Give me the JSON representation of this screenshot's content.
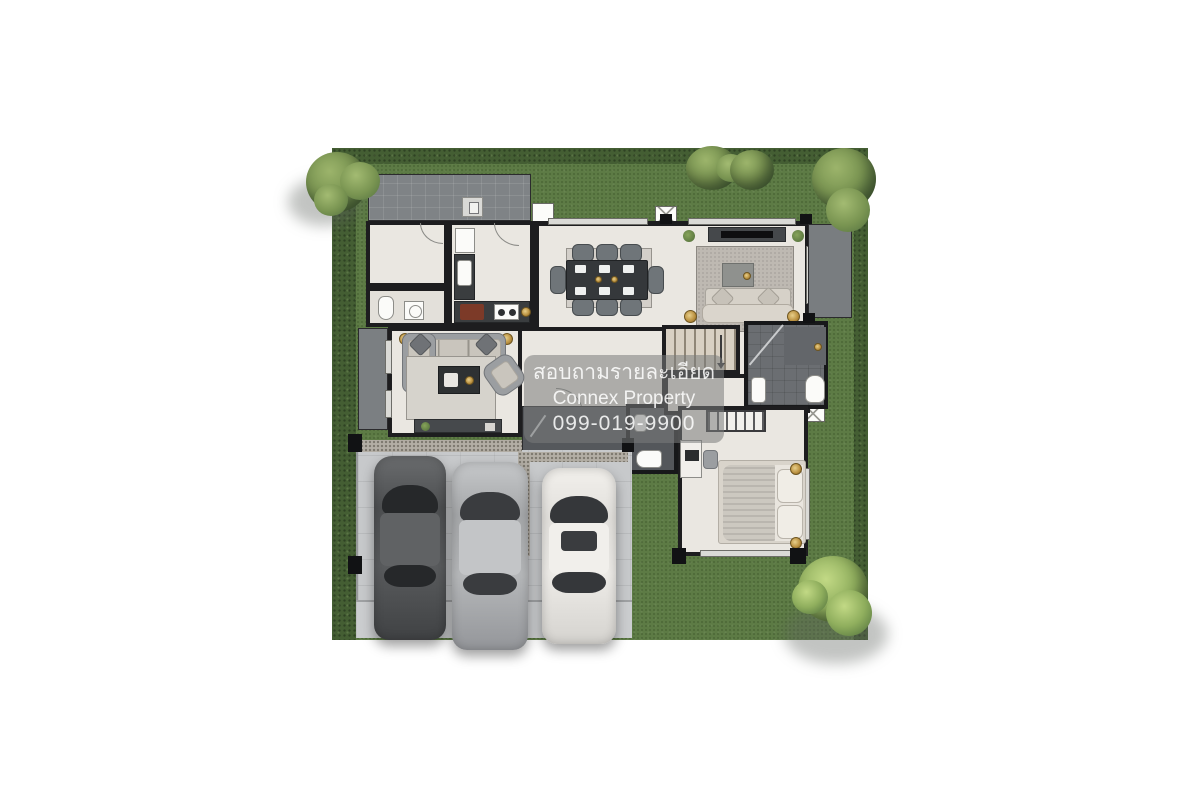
{
  "watermark": {
    "line1": "สอบถามรายละเอียด",
    "line2": "Connex Property",
    "line3": "099-019-9900"
  },
  "plan": {
    "type": "floor-plan-top-view",
    "floor": "ground-floor",
    "rooms": [
      "garden",
      "back-terrace",
      "utility-room",
      "utility-bathroom",
      "kitchen",
      "dining-area",
      "living-area",
      "family-room",
      "stair-hall",
      "corridor",
      "entry-porch",
      "powder-room",
      "bathroom",
      "bedroom",
      "west-terrace",
      "side-terrace",
      "garage",
      "driveway"
    ],
    "furniture": [
      "dining-table-8-seats",
      "sectional-sofa",
      "tv-console",
      "coffee-table",
      "rug",
      "armchair",
      "double-bed",
      "wardrobe",
      "desk-with-computer",
      "desk-chair",
      "toilet",
      "washing-machine",
      "sink",
      "stove",
      "fridge",
      "shower",
      "speakers",
      "plants",
      "bedside-lamps"
    ],
    "vehicles": [
      {
        "name": "car-dark-gray",
        "color": "#515355"
      },
      {
        "name": "car-silver",
        "color": "#AEB0B2"
      },
      {
        "name": "car-white",
        "color": "#E9E7E3"
      }
    ],
    "trees": 4,
    "ac_units": 3
  },
  "colors": {
    "background": "#FFFFFF",
    "lawn": "#5D7B45",
    "hedge": "#445E33",
    "wall": "#1D1D1F",
    "floor": "#EAE7E1",
    "terrace_tile": "#7F8386",
    "bath_tile": "#6B6E72",
    "porch_tile": "#55585C",
    "garage_floor": "#C7C9CB",
    "gravel": "#B3AEA5",
    "driveway": "#CBCDCF",
    "accent_gold": "#B98F3E",
    "watermark_text": "#FFFFFF"
  }
}
